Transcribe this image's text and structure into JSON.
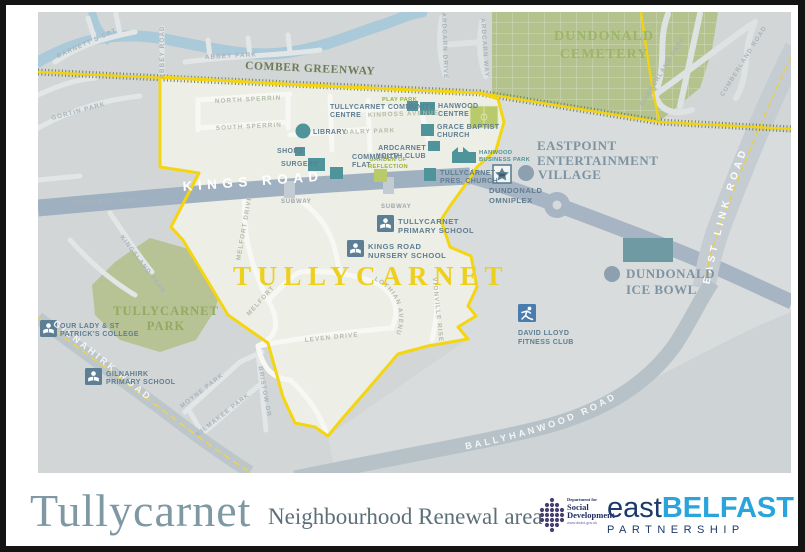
{
  "colors": {
    "boundary_yellow": "#f4d512",
    "estate_cream": "#edeee5",
    "map_gray": "#d2d6d6",
    "building_teal": "#4f949a",
    "label_slate": "#5f7e92",
    "green_area": "#b4c28d",
    "road_band": "#9fb0c0",
    "logo_blue": "#29a4dd",
    "logo_navy": "#1b3a6b",
    "dsd_purple": "#473f6f"
  },
  "map": {
    "labels": {
      "barnetts_crt": "BARNETT'S CRT",
      "abbey_road": "ABBEY ROAD",
      "abbey_park": "ABBEY PARK",
      "gortin_park": "GORTIN PARK",
      "comber_greenway": "COMBER GREENWAY",
      "dundonald_cemetery": [
        "DUNDONALD",
        "CEMETERY"
      ],
      "ardcarn_drive": "ARDCARN DRIVE",
      "ardcarn_way": "ARDCARN WAY",
      "cumberland_park": "CUMBERLAND PARK",
      "cumberland_road": "CUMBERLAND ROAD",
      "east_link_road": "EAST LINK ROAD",
      "north_sperrin": "NORTH SPERRIN",
      "south_sperrin": "SOUTH SPERRIN",
      "dalry_park": "DALRY PARK",
      "kinross_avenue": "KINROSS AVENUE",
      "play_park": "PLAY PARK",
      "tullycarnet_community_centre": [
        "TULLYCARNET COMMUNITY",
        "CENTRE"
      ],
      "hanwood_centre": [
        "HANWOOD",
        "CENTRE"
      ],
      "library": "LIBRARY",
      "grace_baptist_church": [
        "GRACE BAPTIST",
        "CHURCH"
      ],
      "shops": "SHOPS",
      "surgery": "SURGERY",
      "community_flat": [
        "COMMUNITY",
        "FLAT"
      ],
      "ardcarnet_youth_club": [
        "ARDCARNET",
        "YOUTH CLUB"
      ],
      "garden_of_reflection": [
        "GARDEN OF",
        "REFLECTION"
      ],
      "hanwood_business_park": [
        "HANWOOD",
        "BUSINESS PARK"
      ],
      "tullycarnet_pres_church": [
        "TULLYCARNET",
        "PRES. CHURCH"
      ],
      "eastpoint": [
        "EASTPOINT",
        "ENTERTAINMENT",
        "VILLAGE"
      ],
      "dundonald_omniplex": [
        "DUNDONALD",
        "OMNIPLEX"
      ],
      "kings_road": "KINGS ROAD",
      "subway": "SUBWAY",
      "tullycarnet_primary_school": [
        "TULLYCARNET",
        "PRIMARY SCHOOL"
      ],
      "kings_road_nursery_school": [
        "KINGS ROAD",
        "NURSERY SCHOOL"
      ],
      "tullycarnet_area": "TULLYCARNET",
      "melfort_drive": "MELFORT DRIVE",
      "melfort": "MELFORT",
      "leven_drive": "LEVEN DRIVE",
      "lothian_avenue": "LOTHIAN AVENUE",
      "vionville_rise": "VIONVILLE RISE",
      "kingsway_park": "KINGSWAY PARK",
      "kingsland_park": "KINGSLAND PARK",
      "tullycarnet_park": [
        "TULLYCARNET",
        "PARK"
      ],
      "our_lady": [
        "OUR LADY & ST",
        "PATRICK'S COLLEGE"
      ],
      "gilnahirk_primary_school": [
        "GILNAHIRK",
        "PRIMARY SCHOOL"
      ],
      "gilnahirk_road": "GILNAHIRK ROAD",
      "moyne_park": "MOYNE PARK",
      "kilmakee_park": "KILMAKEE PARK",
      "bristow_dr": "BRISTOW DR",
      "dundonald_ice_bowl": [
        "DUNDONALD",
        "ICE BOWL"
      ],
      "david_lloyd": [
        "DAVID LLOYD",
        "FITNESS CLUB"
      ],
      "ballyhanwood_road": "BALLYHANWOOD ROAD"
    }
  },
  "footer": {
    "title": "Tullycarnet",
    "subtitle": "Neighbourhood Renewal area",
    "dsd": {
      "line1": "Department for",
      "line2": "Social",
      "line3": "Development",
      "url": "www.dsdni.gov.uk"
    },
    "partnership": {
      "east": "east",
      "belfast": "BELFAST",
      "sub": "PARTNERSHIP"
    }
  }
}
